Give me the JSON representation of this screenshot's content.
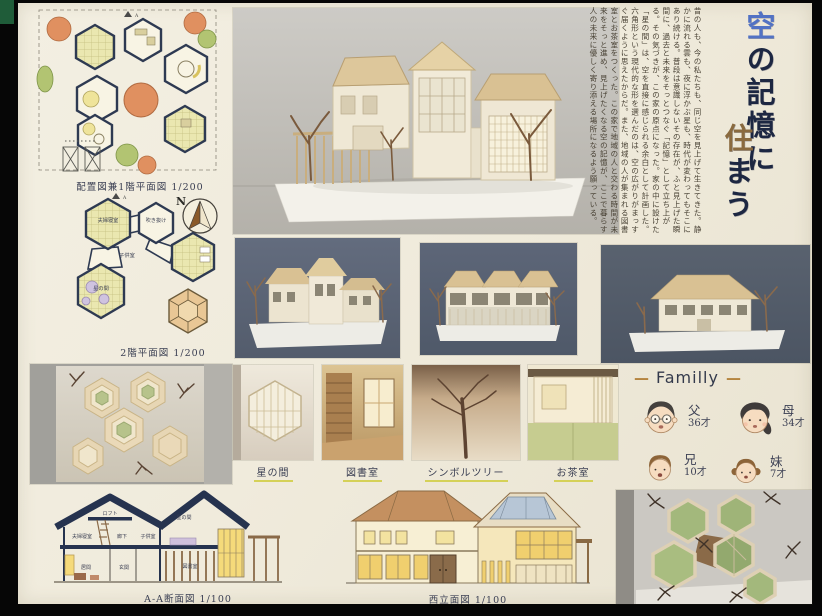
{
  "board": {
    "title": {
      "chars": [
        "空",
        "の",
        "記",
        "憶",
        "に",
        "住",
        "ま",
        "う"
      ],
      "accent_blue": "#5272c4",
      "accent_gold": "#8a6a3f",
      "ink": "#1d2742"
    },
    "intro": {
      "text": "昔の人も、今の私たちも、同じ空を見上げて生きてきた。静かに流れる雲も、夜に浮かぶ星も、時代が変わってもそこにあり続ける。普段は意識しないその存在が、ふと見上げた瞬間に、過去と未来をそっとつなぐ「記憶」として立ち上がる。その気づきが、この家の原点になった。家の中に設けた「星の間」は、空を直接に感じられる余白として計画した。六角形という現代的な形を選んだのは、空の広がりがまっすぐ届くように思えたからだ。また、地域の人が集まれる図書室とお茶室をつくった。この家で地域の人と交わる時間が未来をそっと進め、見上げたくなる空の記憶が、ここで暮らす人の未来に優しく寄り添える場所になるよう願っている。"
    },
    "captions": {
      "site_plan": "配置図兼1階平面図 1/200",
      "floor2_plan": "2階平面図 1/200",
      "section": "A-A断面図 1/100",
      "west_elevation": "西立面図 1/100"
    },
    "compass_label": "N",
    "plan_marker": "A",
    "plan2f_labels": {
      "master_bedroom": "夫婦寝室",
      "void": "吹き抜け",
      "kids_room": "子供室",
      "star_room": "星の間"
    },
    "section_labels": {
      "loft": "ロフト",
      "master_bedroom": "夫婦寝室",
      "corridor": "廊下",
      "kids_room": "子供室",
      "star_room": "星の間",
      "living": "居間",
      "entrance": "玄関",
      "library": "図書室"
    },
    "detail_photos": [
      {
        "label": "星の間"
      },
      {
        "label": "図書室"
      },
      {
        "label": "シンボルツリー"
      },
      {
        "label": "お茶室"
      }
    ],
    "family": {
      "dash": "—",
      "name": "Familly",
      "members": [
        {
          "role": "父",
          "age": "36才"
        },
        {
          "role": "母",
          "age": "34才"
        },
        {
          "role": "兄",
          "age": "10才"
        },
        {
          "role": "妹",
          "age": "7才"
        }
      ]
    },
    "colors": {
      "board_paper": "#f0ecdd",
      "ink_navy": "#1d2742",
      "photo_backdrop_dark": "#5c6577",
      "roof_tan": "#d9c193",
      "window_yellow": "#f2d671",
      "plan_fill": "#eae7b0",
      "highlight_underline": "#d5d158"
    }
  }
}
